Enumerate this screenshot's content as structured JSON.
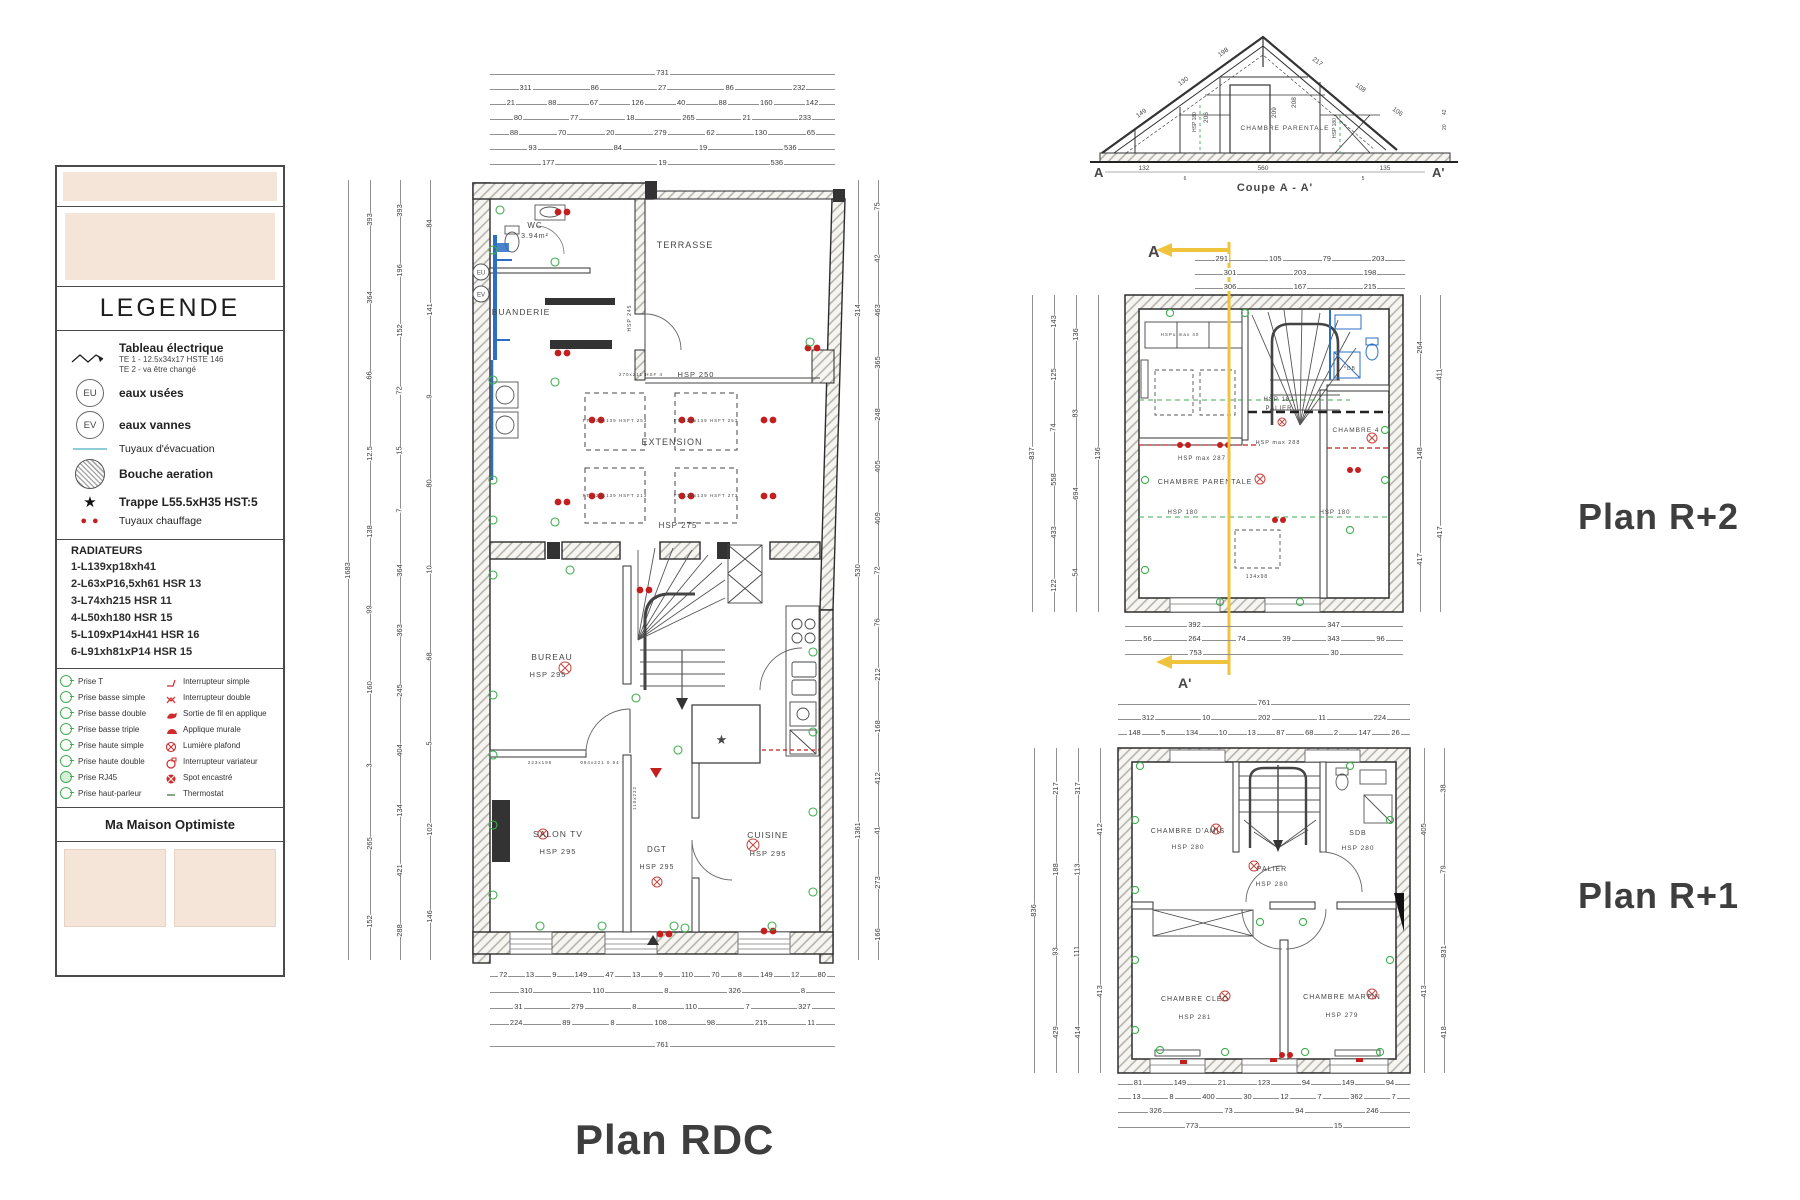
{
  "titles": {
    "plan_rdc": "Plan RDC",
    "plan_r2": "Plan R+2",
    "plan_r1": "Plan R+1",
    "coupe": "Coupe A - A'"
  },
  "legend": {
    "title": "LEGENDE",
    "tableau": {
      "label": "Tableau électrique",
      "line1": "TE 1 - 12.5x34x17 HSTE 146",
      "line2": "TE 2 -    va être changé"
    },
    "eu": {
      "symbol": "EU",
      "label": "eaux usées"
    },
    "ev": {
      "symbol": "EV",
      "label": "eaux vannes"
    },
    "evac": "Tuyaux d'évacuation",
    "bouche": "Bouche aeration",
    "trappe": "Trappe L55.5xH35 HST:5",
    "trappe_symbol": "★",
    "chauffage": "Tuyaux chauffage",
    "chauffage_symbol": "● ●",
    "radiateurs_title": "RADIATEURS",
    "radiateurs": [
      "1-L139xp18xh41",
      "2-L63xP16,5xh61 HSR 13",
      "3-L74xh215 HSR 11",
      "4-L50xh180 HSR 15",
      "5-L109xP14xH41 HSR 16",
      "6-L91xh81xP14 HSR 15"
    ],
    "symbols_left": [
      "Prise T",
      "Prise basse simple",
      "Prise basse double",
      "Prise basse triple",
      "Prise haute simple",
      "Prise haute double",
      "Prise RJ45",
      "Prise haut-parleur"
    ],
    "symbols_right": [
      "Interrupteur simple",
      "Interrupteur double",
      "Sortie de fil en applique",
      "Applique murale",
      "Lumière plafond",
      "Interrupteur variateur",
      "Spot encastré",
      "Thermostat"
    ],
    "footer": "Ma Maison Optimiste"
  },
  "plan_rdc": {
    "rooms": {
      "wc": "WC",
      "wc_area": "3.94m²",
      "buanderie": "BUANDERIE",
      "terrasse": "TERRASSE",
      "extension": "EXTENSION",
      "extension_hsp": "HSP 275",
      "beam_note": "270x211 HSF 4",
      "beam_hsp": "HSP 250",
      "hsp245": "HSP 245",
      "bureau": "BUREAU",
      "bureau_hsp": "HSP 295",
      "salon": "SALON TV",
      "salon_hsp": "HSP 295",
      "dgt": "DGT",
      "dgt_hsp": "HSP 295",
      "cuisine": "CUISINE",
      "cuisine_hsp": "HSP 295",
      "ft1": "FT 129x139 HSFT 253",
      "ft2": "FT 129x139 HSFT 253",
      "ft3": "FT 129x139 HSFT 213",
      "ft4": "FT 129x139 HSFT 273",
      "door1": "223x198",
      "door2": "094x221 0.94",
      "door3": "110x232",
      "star": "★"
    },
    "dims": {
      "t1": [
        "731"
      ],
      "t2": [
        "311",
        "86",
        "27",
        "86",
        "232"
      ],
      "t3": [
        "21",
        "88",
        "67",
        "126",
        "40",
        "88",
        "160",
        "142"
      ],
      "t4": [
        "80",
        "77",
        "18",
        "265",
        "21",
        "233"
      ],
      "t5": [
        "88",
        "70",
        "20",
        "279",
        "62",
        "130",
        "65"
      ],
      "t6": [
        "93",
        "84",
        "19",
        "536"
      ],
      "t7": [
        "177",
        "19",
        "536"
      ],
      "l1": [
        "1683"
      ],
      "l2": [
        "393",
        "364",
        "66",
        "12.5",
        "138",
        "99",
        "160",
        "3",
        "265",
        "152"
      ],
      "l3": [
        "393",
        "196",
        "152",
        "72",
        "15",
        "7",
        "364",
        "363",
        "245",
        "404",
        "134",
        "421",
        "288"
      ],
      "l4": [
        "84",
        "141",
        "9",
        "80",
        "10",
        "68",
        "5",
        "102",
        "146"
      ],
      "r1": [
        "314",
        "530",
        "1361"
      ],
      "r2": [
        "75",
        "42",
        "463",
        "365",
        "248",
        "405",
        "409",
        "72",
        "76",
        "212",
        "168",
        "412",
        "41",
        "273",
        "166"
      ],
      "b1": [
        "72",
        "13",
        "9",
        "149",
        "47",
        "13",
        "9",
        "110",
        "70",
        "8",
        "149",
        "12",
        "80"
      ],
      "b2": [
        "310",
        "110",
        "8",
        "326",
        "8"
      ],
      "b3": [
        "31",
        "279",
        "8",
        "110",
        "7",
        "327"
      ],
      "b4": [
        "224",
        "89",
        "8",
        "108",
        "98",
        "215",
        "11"
      ],
      "b5": [
        "761"
      ]
    }
  },
  "coupe": {
    "a": "A",
    "a2": "A'",
    "room": "CHAMBRE PARENTALE",
    "hsp_line": "HSP 180",
    "dims": {
      "slope_l": [
        "149",
        "130",
        "198"
      ],
      "slope_r": [
        "217",
        "108",
        "106"
      ],
      "inner": [
        "209",
        "208",
        "206"
      ],
      "bottom": [
        "132",
        "560",
        "135"
      ],
      "small": [
        "6",
        "5",
        "42",
        "20"
      ]
    }
  },
  "plan_r2": {
    "section": {
      "a": "A",
      "a2": "A'"
    },
    "rooms": {
      "parentale": "CHAMBRE PARENTALE",
      "hsp_max": "HSP max 287",
      "hsp_max2": "HSP max 288",
      "ch4": "CHAMBRE 4",
      "hsp180a": "HSP 180",
      "hsp180b": "HSP 180",
      "palier": "PALIER",
      "palier_hsp": "HSP 182",
      "wardrobe": "HSPu max 40",
      "velux": "134x98",
      "db": "*DB"
    },
    "dims": {
      "t1": [
        "291",
        "105",
        "79",
        "203"
      ],
      "t2": [
        "301",
        "203",
        "198"
      ],
      "t3": [
        "306",
        "167",
        "215"
      ],
      "l1": [
        "837"
      ],
      "l2": [
        "143",
        "125",
        "74",
        "558",
        "433",
        "122"
      ],
      "l3": [
        "136",
        "83",
        "694",
        "54"
      ],
      "l4": [
        "136"
      ],
      "r1": [
        "264",
        "148",
        "417"
      ],
      "r2": [
        "411",
        "417"
      ],
      "b1": [
        "392",
        "347"
      ],
      "b2": [
        "56",
        "264",
        "74",
        "39",
        "343",
        "96"
      ],
      "b3": [
        "753",
        "30"
      ]
    }
  },
  "plan_r1": {
    "rooms": {
      "amis": "CHAMBRE D'AMIS",
      "amis_hsp": "HSP 280",
      "sdb": "SDB",
      "sdb_hsp": "HSP 280",
      "palier": "PALIER",
      "palier_hsp": "HSP 280",
      "cleo": "CHAMBRE CLÉO",
      "cleo_hsp": "HSP 281",
      "martin": "CHAMBRE MARTIN",
      "martin_hsp": "HSP 279"
    },
    "dims": {
      "t1": [
        "761"
      ],
      "t2": [
        "312",
        "10",
        "202",
        "11",
        "224"
      ],
      "t3": [
        "148",
        "5",
        "134",
        "10",
        "13",
        "87",
        "68",
        "2",
        "147",
        "26"
      ],
      "l1": [
        "836"
      ],
      "l2": [
        "217",
        "188",
        "93",
        "429"
      ],
      "l3": [
        "317",
        "113",
        "111",
        "414"
      ],
      "l4": [
        "412",
        "413"
      ],
      "r1": [
        "405",
        "413"
      ],
      "r2": [
        "38",
        "79",
        "831",
        "418"
      ],
      "b1": [
        "81",
        "149",
        "21",
        "123",
        "94",
        "149",
        "94"
      ],
      "b2": [
        "13",
        "8",
        "400",
        "30",
        "12",
        "7",
        "362",
        "7"
      ],
      "b3": [
        "326",
        "73",
        "94",
        "246"
      ],
      "b4": [
        "773",
        "15"
      ]
    }
  }
}
